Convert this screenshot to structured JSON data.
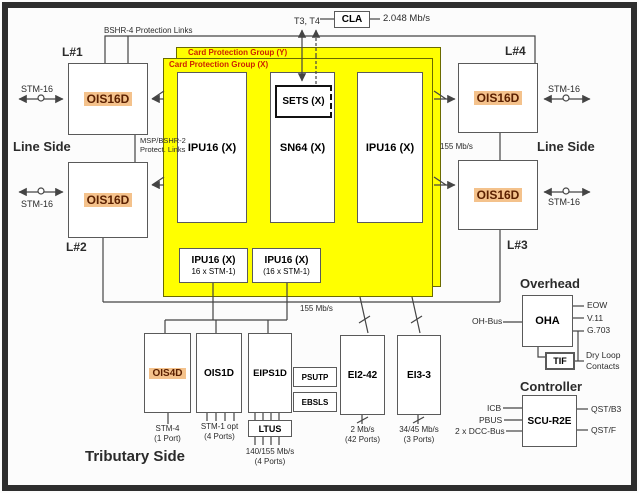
{
  "colors": {
    "panel_yellow": "#ffff00",
    "highlight_orange": "#f4c28c",
    "group_label_red": "#cc2200"
  },
  "top": {
    "bshr4": "BSHR-4 Protection Links",
    "t3t4": "T3, T4",
    "cla": "CLA",
    "cla_rate": "2.048 Mb/s"
  },
  "line_side_left": {
    "heading": "Line Side",
    "l1": "L#1",
    "l2": "L#2",
    "stm16_top": "STM-16",
    "stm16_bottom": "STM-16",
    "card1": "OIS16D",
    "card2": "OIS16D",
    "msp_line1": "MSP/BSHR-2",
    "msp_line2": "Protect. Links"
  },
  "line_side_right": {
    "heading": "Line Side",
    "l4": "L#4",
    "l3": "L#3",
    "stm16_top": "STM-16",
    "stm16_bottom": "STM-16",
    "card4": "OIS16D",
    "card3": "OIS16D",
    "rate": "155 Mb/s"
  },
  "protection": {
    "group_y": "Card Protection Group (Y)",
    "group_x": "Card Protection Group (X)",
    "ipu_left": "IPU16 (X)",
    "sn64": "SN64 (X)",
    "sets": "SETS (X)",
    "ipu_right": "IPU16 (X)",
    "ipu_sub1": {
      "l1": "IPU16 (X)",
      "l2": "16 x STM-1)"
    },
    "ipu_sub2": {
      "l1": "IPU16 (X)",
      "l2": "(16 x STM-1)"
    }
  },
  "bus_rate": "155 Mb/s",
  "tributary": {
    "heading": "Tributary Side",
    "ois4d": "OIS4D",
    "ois4d_sub1": "STM-4",
    "ois4d_sub2": "(1 Port)",
    "ois1d": "OIS1D",
    "ois1d_sub1": "STM-1 opt",
    "ois1d_sub2": "(4 Ports)",
    "eips1d": "EIPS1D",
    "psutp": "PSUTP",
    "ebsls": "EBSLS",
    "ltus": "LTUS",
    "ltus_sub1": "140/155 Mb/s",
    "ltus_sub2": "(4 Ports)",
    "ei242": "EI2-42",
    "ei242_sub1": "2 Mb/s",
    "ei242_sub2": "(42 Ports)",
    "ei33": "EI3-3",
    "ei33_sub1": "34/45 Mb/s",
    "ei33_sub2": "(3 Ports)"
  },
  "overhead": {
    "heading": "Overhead",
    "oha": "OHA",
    "oh_bus": "OH-Bus",
    "eow": "EOW",
    "v11": "V.11",
    "g703": "G.703",
    "tif": "TIF",
    "dry_loop_1": "Dry Loop",
    "dry_loop_2": "Contacts"
  },
  "controller": {
    "heading": "Controller",
    "scu": "SCU-R2E",
    "icb": "ICB",
    "pbus": "PBUS",
    "dcc": "2 x DCC-Bus",
    "qst_b3": "QST/B3",
    "qst_f": "QST/F"
  }
}
